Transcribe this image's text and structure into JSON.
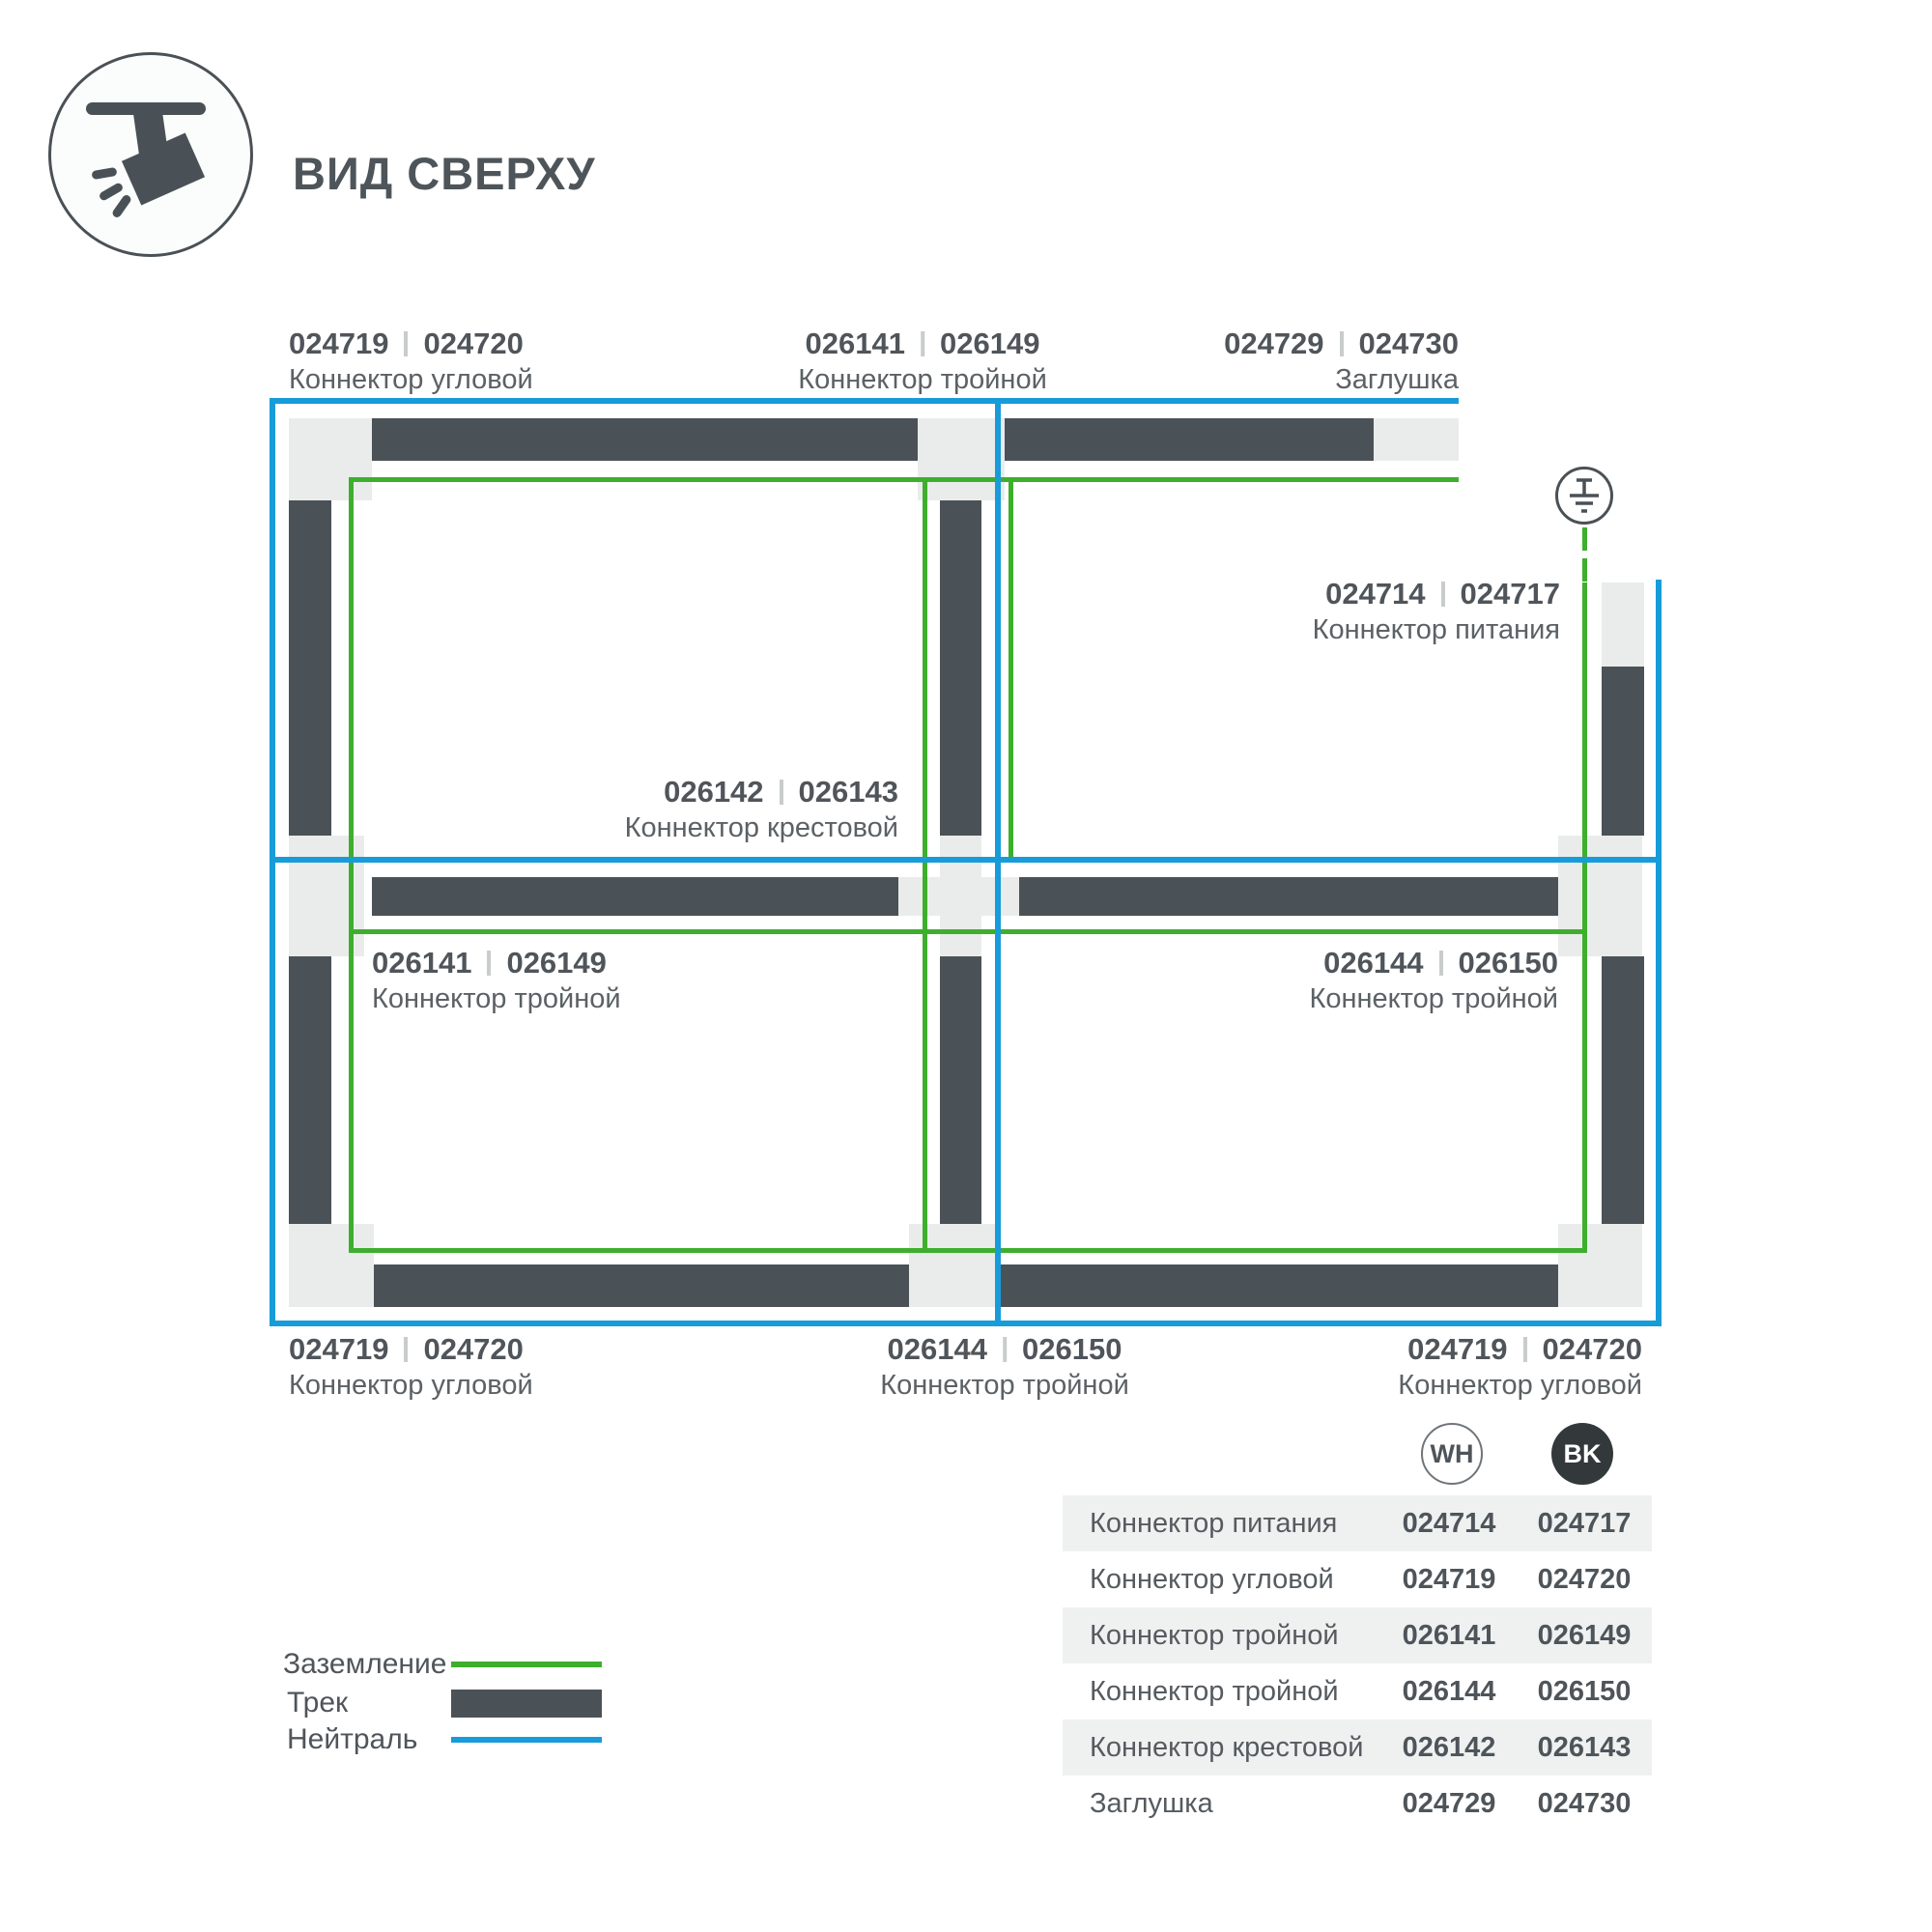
{
  "header": {
    "title": "ВИД СВЕРХУ"
  },
  "colors": {
    "track": "#4B5257",
    "connector_pad": "#EAECEC",
    "ground_green": "#3EAF2D",
    "neutral_blue": "#189CD9",
    "text_dark": "#4F555A",
    "table_band": "#EFF1F1",
    "bk_badge": "#33383B"
  },
  "diagram": {
    "labels": [
      {
        "code_wh": "024719",
        "code_bk": "024720",
        "name": "Коннектор угловой"
      },
      {
        "code_wh": "026141",
        "code_bk": "026149",
        "name": "Коннектор тройной"
      },
      {
        "code_wh": "024729",
        "code_bk": "024730",
        "name": "Заглушка"
      },
      {
        "code_wh": "024714",
        "code_bk": "024717",
        "name": "Коннектор питания"
      },
      {
        "code_wh": "026142",
        "code_bk": "026143",
        "name": "Коннектор крестовой"
      },
      {
        "code_wh": "026141",
        "code_bk": "026149",
        "name": "Коннектор тройной"
      },
      {
        "code_wh": "026144",
        "code_bk": "026150",
        "name": "Коннектор тройной"
      },
      {
        "code_wh": "024719",
        "code_bk": "024720",
        "name": "Коннектор угловой"
      },
      {
        "code_wh": "026144",
        "code_bk": "026150",
        "name": "Коннектор тройной"
      },
      {
        "code_wh": "024719",
        "code_bk": "024720",
        "name": "Коннектор угловой"
      }
    ]
  },
  "legend": {
    "items": [
      {
        "label": "Заземление",
        "kind": "ground-line"
      },
      {
        "label": "Трек",
        "kind": "track-bar"
      },
      {
        "label": "Нейтраль",
        "kind": "neutral-line"
      }
    ]
  },
  "table": {
    "columns": [
      {
        "label": "WH"
      },
      {
        "label": "BK"
      }
    ],
    "rows": [
      {
        "name": "Коннектор питания",
        "wh": "024714",
        "bk": "024717"
      },
      {
        "name": "Коннектор угловой",
        "wh": "024719",
        "bk": "024720"
      },
      {
        "name": "Коннектор тройной",
        "wh": "026141",
        "bk": "026149"
      },
      {
        "name": "Коннектор тройной",
        "wh": "026144",
        "bk": "026150"
      },
      {
        "name": "Коннектор крестовой",
        "wh": "026142",
        "bk": "026143"
      },
      {
        "name": "Заглушка",
        "wh": "024729",
        "bk": "024730"
      }
    ]
  }
}
